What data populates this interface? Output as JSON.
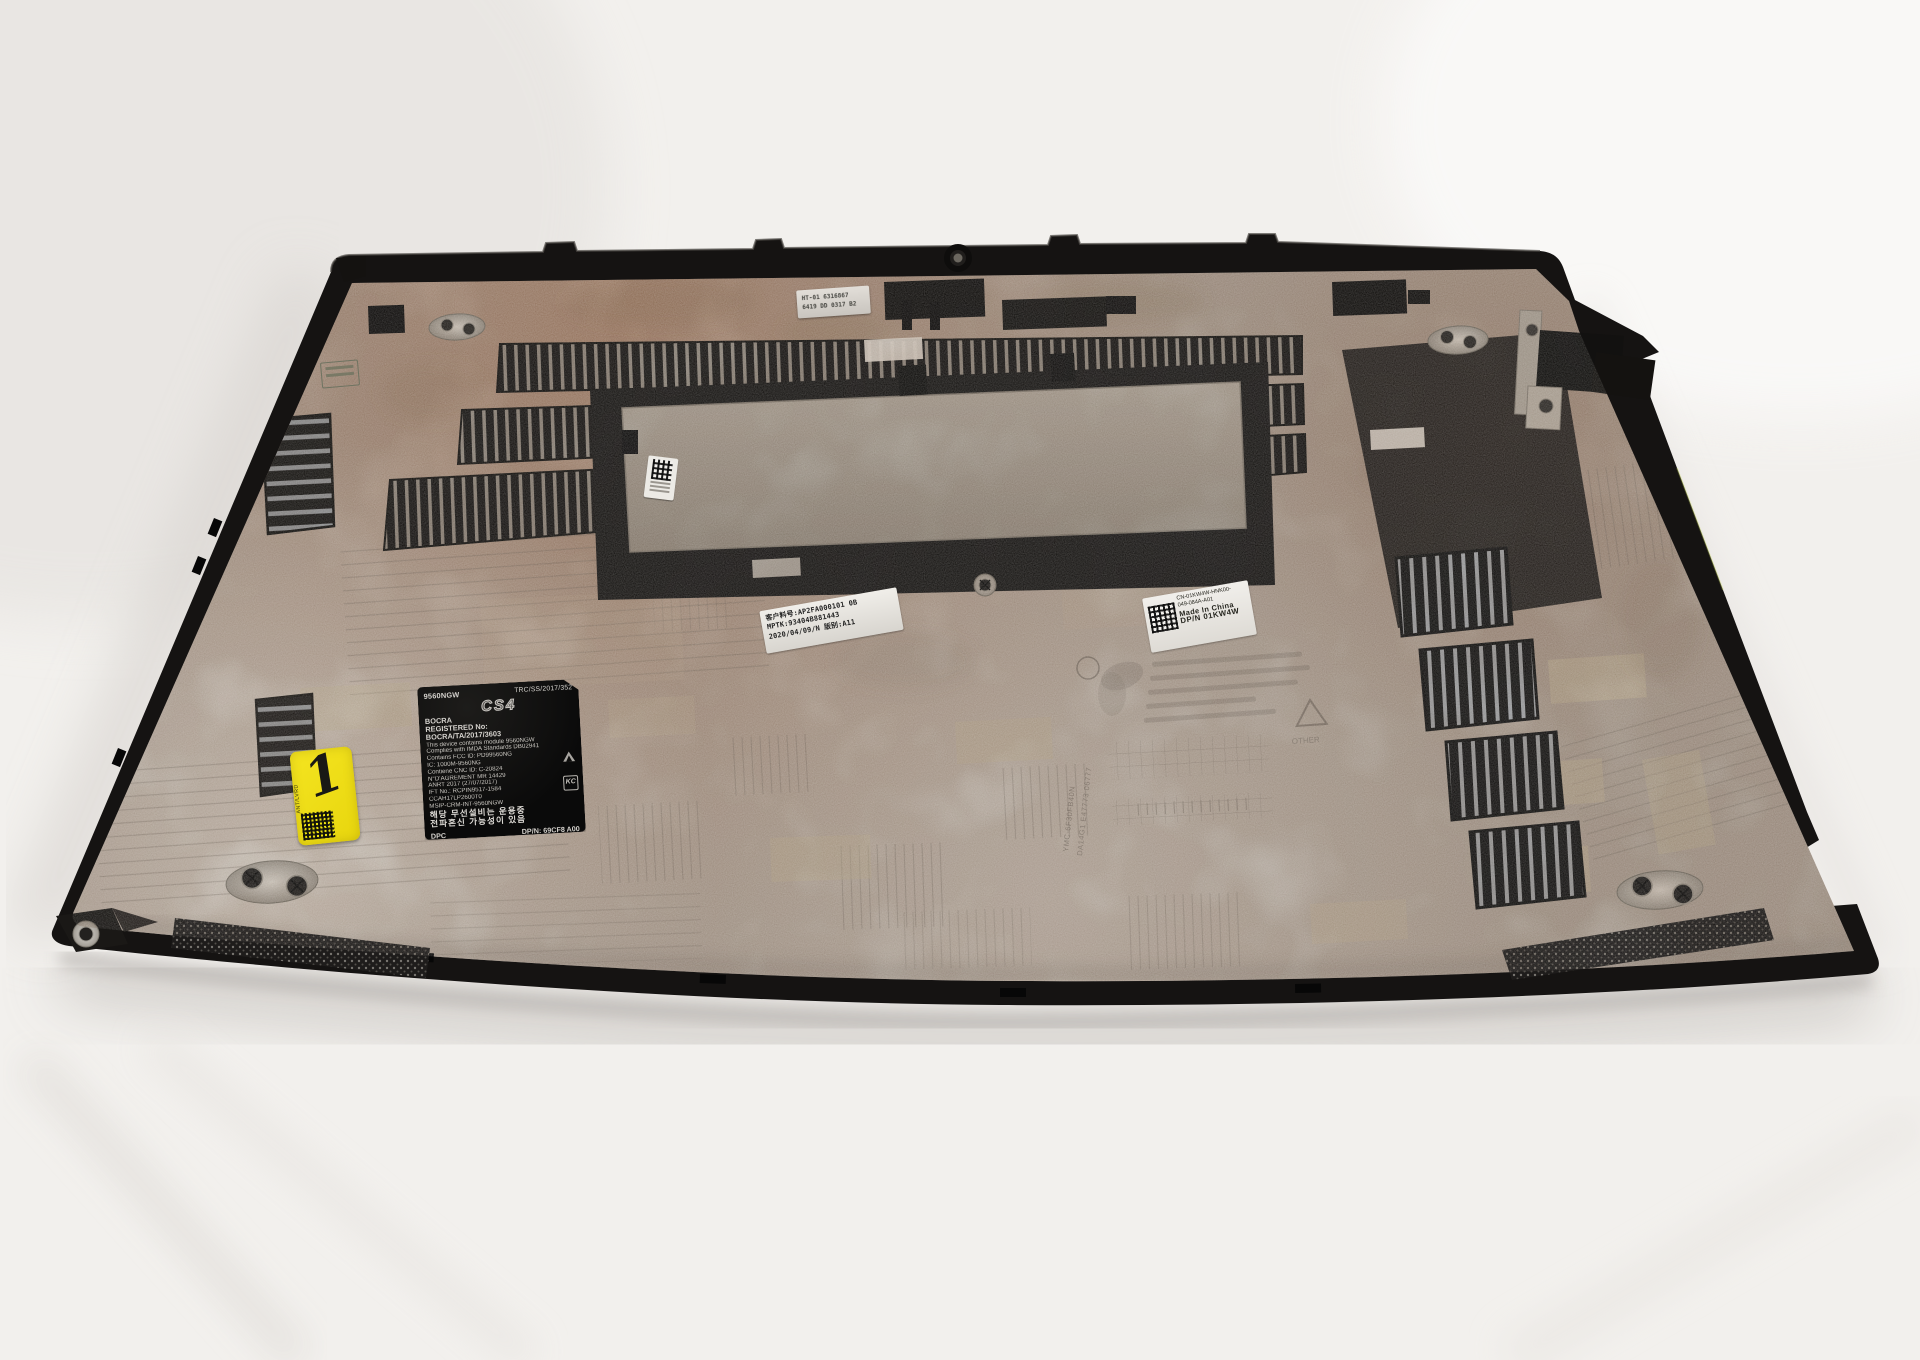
{
  "scene": {
    "subject": "Laptop bottom base cover enclosure, interior side up, photographed on a white studio background"
  },
  "colors": {
    "background": "#f3f1ee",
    "cover_black": "#171513",
    "surface_gray": "#b3a99f",
    "copper_dust": "#a97f63",
    "plate_silver": "#aba59b",
    "label_yellow": "#f2df12"
  },
  "labels": {
    "service_tag": {
      "line1": "HT-01 6316867",
      "line2": "6419 DD 0317 B2"
    },
    "regulatory": {
      "model": "9560NGW",
      "trc_number": "TRC/SS/2017/352",
      "logo_text": "CS4",
      "bocra_name": "BOCRA",
      "registered_label": "REGISTERED No:",
      "bocra_number": "BOCRA/TA/2017/3603",
      "module_line": "This device contains module 9560NGW",
      "imda_line": "Complies with IMDA Standards DB02941",
      "fcc_line": "Contains FCC ID: PD99560NG",
      "ic_line": "IC: 1000M-9560NG",
      "cnc_line": "Contiene CNC ID: C-20824",
      "agrement_line": "N°D'AGRÉMENT MR 14429",
      "anrt_line": "ANRT 2017 (27/07/2017)",
      "ift_line": "IFT No.: RCPIN9517-1584",
      "ccah_line": "CCAH17LP2600T0",
      "msip_line": "MSIP-CRM-INT-9560NGW",
      "korean_line1": "해당 무선설비는 운용중",
      "korean_line2": "전파혼신 가능성이 있음",
      "dpc_mark": "DPC",
      "dpn_line": "DP/N: 69CF8 A00",
      "kc_mark": "KC"
    },
    "part_number_label": {
      "line1": "客户料号:AP2FA000101  0B",
      "line2": "MPTK:93404B881443",
      "line3": "2020/04/09/N  版别:A11"
    },
    "dell_label": {
      "line1": "CN-01KW4W-HNK00-",
      "line2": "049-084A-A01",
      "line3": "Made In China",
      "line4": "DP/N 01KW4W"
    },
    "yellow_label": {
      "digit": "1",
      "side_text": "ANT/LVRD"
    },
    "etched_markings": {
      "vertical_text_1": "YMC-6F30FB40N",
      "vertical_text_2": "DA14G1 E47773 06777",
      "recycle_text": "OTHER"
    }
  }
}
